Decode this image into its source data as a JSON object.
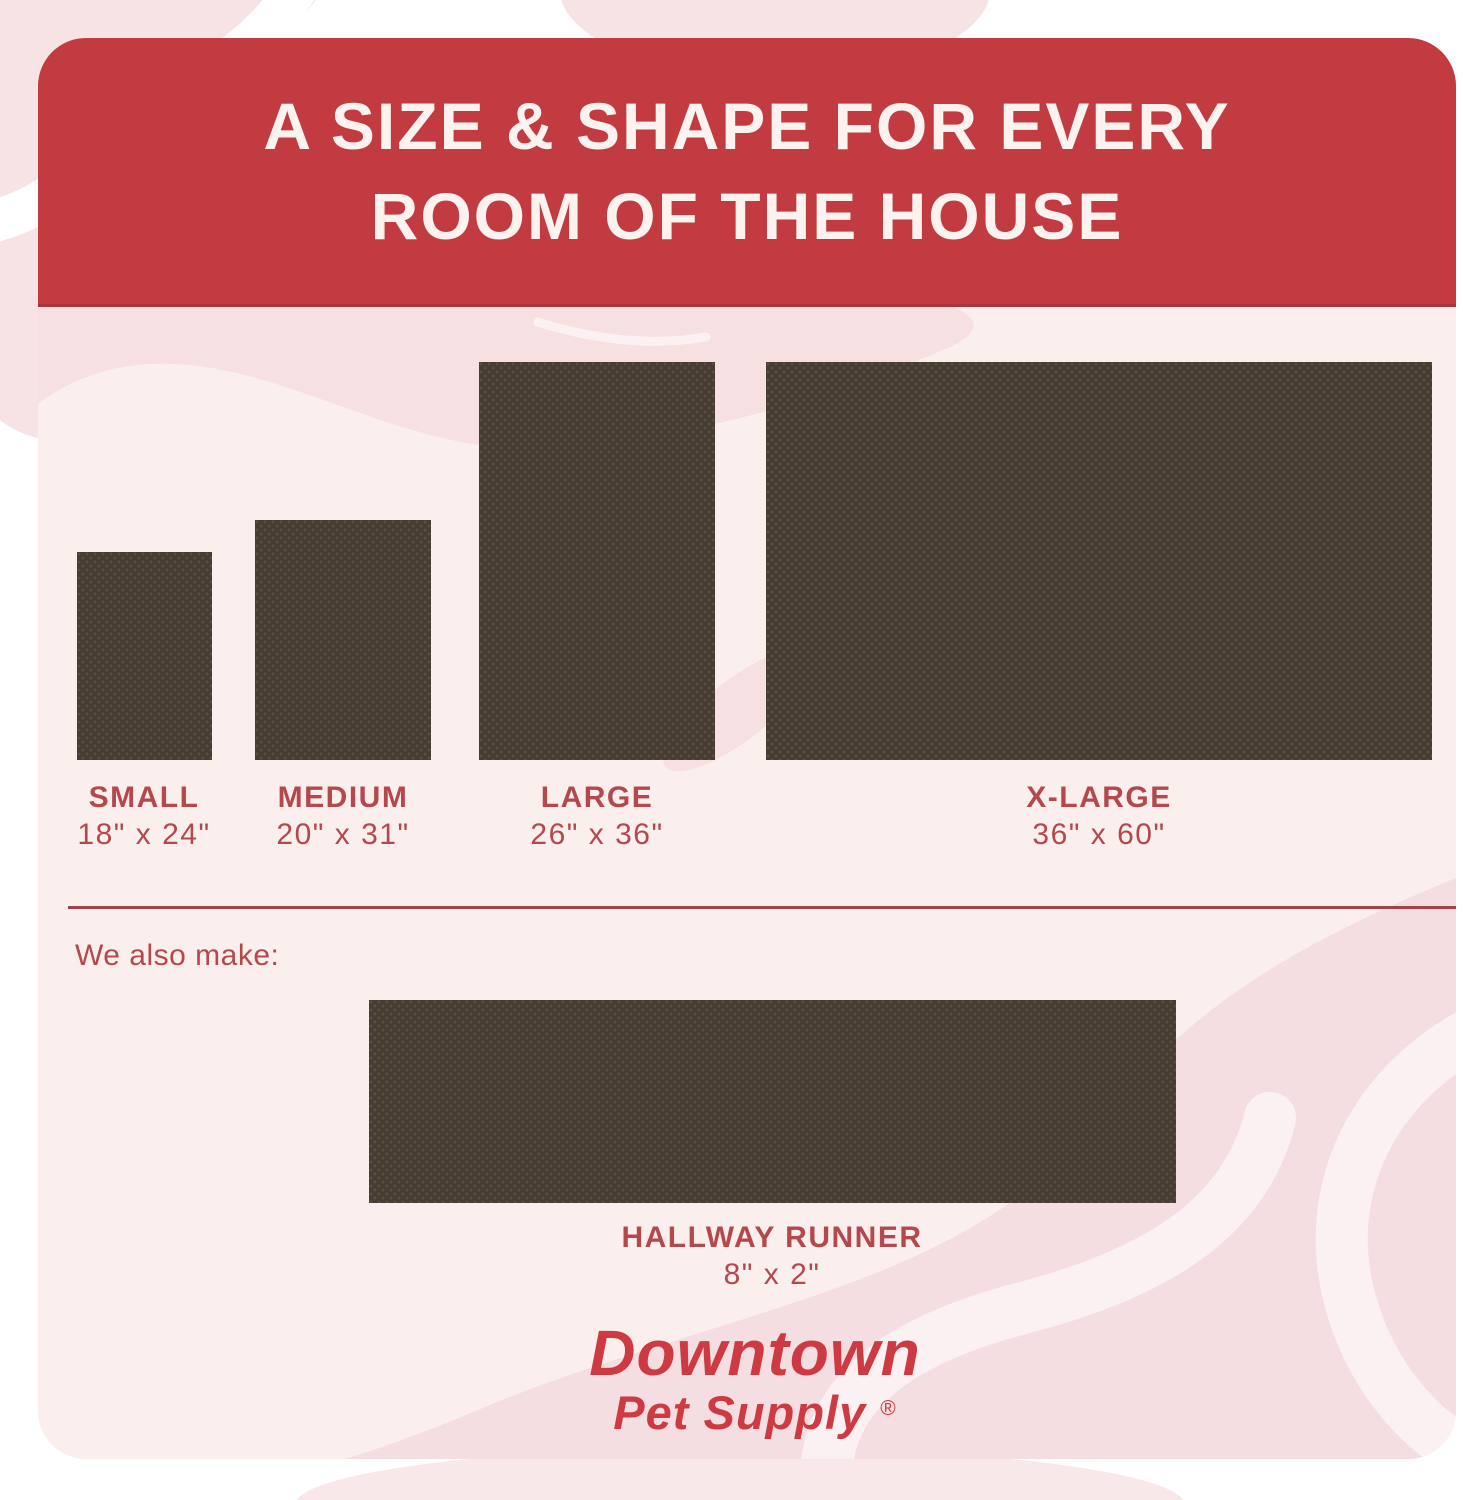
{
  "header": {
    "title_line1": "A SIZE & SHAPE FOR EVERY",
    "title_line2": "ROOM OF THE HOUSE"
  },
  "sizes": [
    {
      "name": "SMALL",
      "dimensions": "18\" x 24\""
    },
    {
      "name": "MEDIUM",
      "dimensions": "20\" x 31\""
    },
    {
      "name": "LARGE",
      "dimensions": "26\" x 36\""
    },
    {
      "name": "X-LARGE",
      "dimensions": "36\" x 60\""
    }
  ],
  "also_make": {
    "label": "We also make:",
    "item": {
      "name": "HALLWAY RUNNER",
      "dimensions": "8\" x 2\""
    }
  },
  "brand": {
    "name": "Downtown",
    "subtitle": "Pet Supply",
    "registered": "®"
  },
  "colors": {
    "banner_red": "#c23b41",
    "accent_red": "#b4484d",
    "divider_red": "#a2424a",
    "logo_red": "#ce3a42",
    "body_pink": "#fbefee",
    "blob_pink": "#f6e0e1",
    "blob_pink_outer": "#f7e3e3",
    "stripe_pink": "#fcf1f2",
    "rug_brown": "#463c31",
    "rug_dot": "#5a5042",
    "header_text": "#fcf2f0"
  }
}
